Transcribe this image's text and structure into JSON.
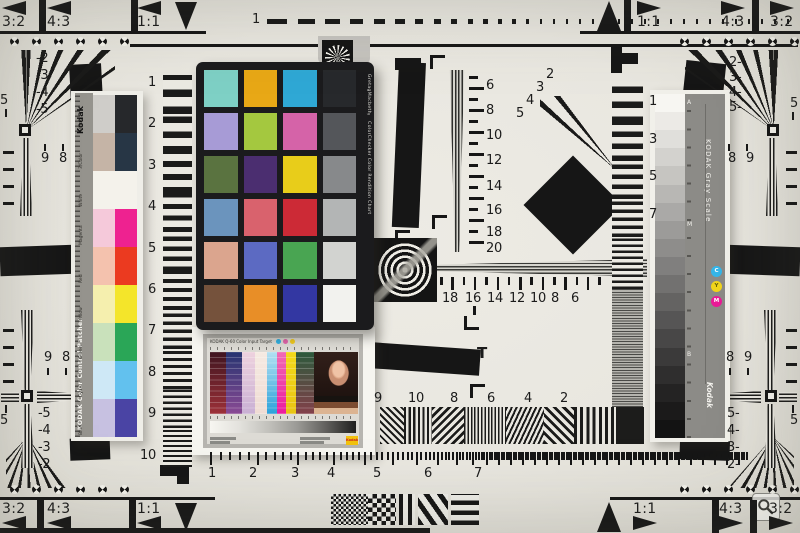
{
  "corner_labels": {
    "tl": [
      "3:2",
      "4:3",
      "1:1"
    ],
    "tr": [
      "1:1",
      "4:3",
      "3:2"
    ],
    "bl": [
      "3:2",
      "4:3",
      "1:1"
    ],
    "br": [
      "1:1",
      "4:3",
      "3:2"
    ]
  },
  "ruler_one": "1",
  "edge_fives": "5",
  "t_mark_label": "T",
  "scales": {
    "left_column": [
      "1",
      "2",
      "3",
      "4",
      "5",
      "6",
      "7",
      "8",
      "9",
      "10"
    ],
    "right_column": [
      "1",
      "3",
      "5",
      "7"
    ],
    "vertical": [
      "6",
      "8",
      "10",
      "12",
      "14",
      "16",
      "18",
      "20"
    ],
    "horizontal": [
      "18",
      "16",
      "14",
      "12",
      "10",
      "8",
      "6"
    ],
    "strip": [
      "9",
      "10",
      "8",
      "6",
      "4",
      "2"
    ],
    "bottom_ruler": [
      "1",
      "2",
      "3",
      "4",
      "5",
      "6",
      "7"
    ]
  },
  "fan_numbers": {
    "top_left": [
      "-2",
      "-3",
      "-4",
      "-5"
    ],
    "top_right": [
      "2-",
      "3-",
      "4-",
      "5-"
    ],
    "bottom_left": [
      "-5",
      "-4",
      "-3",
      "-2"
    ],
    "bottom_right": [
      "5-",
      "4-",
      "3-",
      "2-"
    ],
    "center": [
      "2",
      "3",
      "4",
      "5"
    ],
    "left_upper_pair": [
      "9",
      "8"
    ],
    "left_lower_pair": [
      "9",
      "8"
    ],
    "right_upper_pair": [
      "8",
      "9"
    ],
    "right_lower_pair": [
      "8",
      "9"
    ]
  },
  "colorchecker": {
    "side_label": "GretagMacbeth™ ColorChecker Color Rendition Chart",
    "rows": [
      [
        "#7ed0c5",
        "#e8a816",
        "#2fa8d5",
        "#27292c"
      ],
      [
        "#a79bd6",
        "#a4c83f",
        "#d563a8",
        "#54565a"
      ],
      [
        "#5a7340",
        "#4b2e70",
        "#e8cd1a",
        "#87898b"
      ],
      [
        "#6b94bd",
        "#d9626d",
        "#cc2a36",
        "#b3b5b5"
      ],
      [
        "#dba58e",
        "#5c6ac2",
        "#49a552",
        "#d2d3d0"
      ],
      [
        "#75523c",
        "#e88e27",
        "#3337a2",
        "#f2f2ee"
      ]
    ]
  },
  "kodak_strip": {
    "brand": "Kodak",
    "title": "KODAK Color Control Patches",
    "patches": [
      {
        "name": "Black",
        "tint": "#cfcdc9",
        "solid": "#26282b"
      },
      {
        "name": "3/Color",
        "tint": "#c5b4a6",
        "solid": "#273645"
      },
      {
        "name": "White",
        "tint": "#f4f2eb",
        "solid": "#f4f2eb"
      },
      {
        "name": "Magenta",
        "tint": "#f5c9da",
        "solid": "#ee2290"
      },
      {
        "name": "Red",
        "tint": "#f4c2ae",
        "solid": "#eb3a20"
      },
      {
        "name": "Yellow",
        "tint": "#f5efae",
        "solid": "#f4e52a"
      },
      {
        "name": "Green",
        "tint": "#c9e1bb",
        "solid": "#2aa657"
      },
      {
        "name": "Cyan",
        "tint": "#cee8f6",
        "solid": "#62c1ee"
      },
      {
        "name": "Blue",
        "tint": "#c7c1e1",
        "solid": "#4a44a4"
      }
    ]
  },
  "gray_scale": {
    "title": "KODAK Gray Scale",
    "brand": "Kodak",
    "marks": [
      "A",
      "M",
      "B"
    ],
    "steps": [
      "#f7f6f2",
      "#eceae6",
      "#e0dfdb",
      "#d3d2ce",
      "#c6c5c1",
      "#b8b7b4",
      "#aaa9a7",
      "#9c9b99",
      "#8e8d8b",
      "#807f7e",
      "#727170",
      "#646362",
      "#565555",
      "#484747",
      "#3b3a3a",
      "#2f2e2e",
      "#242323",
      "#1b1a1a",
      "#131313"
    ],
    "dots": [
      {
        "label": "C",
        "color": "#35b6e9"
      },
      {
        "label": "Y",
        "color": "#f2d51b"
      },
      {
        "label": "M",
        "color": "#ea1b97"
      }
    ]
  },
  "q60": {
    "title": "KODAK Q-60 Color Input Target",
    "logo": "Kodak",
    "dots": [
      "#2fb0e2",
      "#e263ab",
      "#f2ca1d"
    ],
    "columns": [
      {
        "top": "#401520",
        "bottom": "#9c3038"
      },
      {
        "top": "#263470",
        "bottom": "#8a4a94"
      },
      {
        "top": "#eed2de",
        "bottom": "#c9b0d4"
      },
      {
        "top": "#f5eae2",
        "bottom": "#efdcd4"
      },
      {
        "top": "#b2e0f2",
        "bottom": "#2ca2da"
      },
      {
        "top": "#f06ab4",
        "bottom": "#ec1c9e"
      },
      {
        "top": "#f2da1a",
        "bottom": "#e8c414"
      },
      {
        "top": "#2c5a3c",
        "bottom": "#83404a"
      }
    ]
  }
}
